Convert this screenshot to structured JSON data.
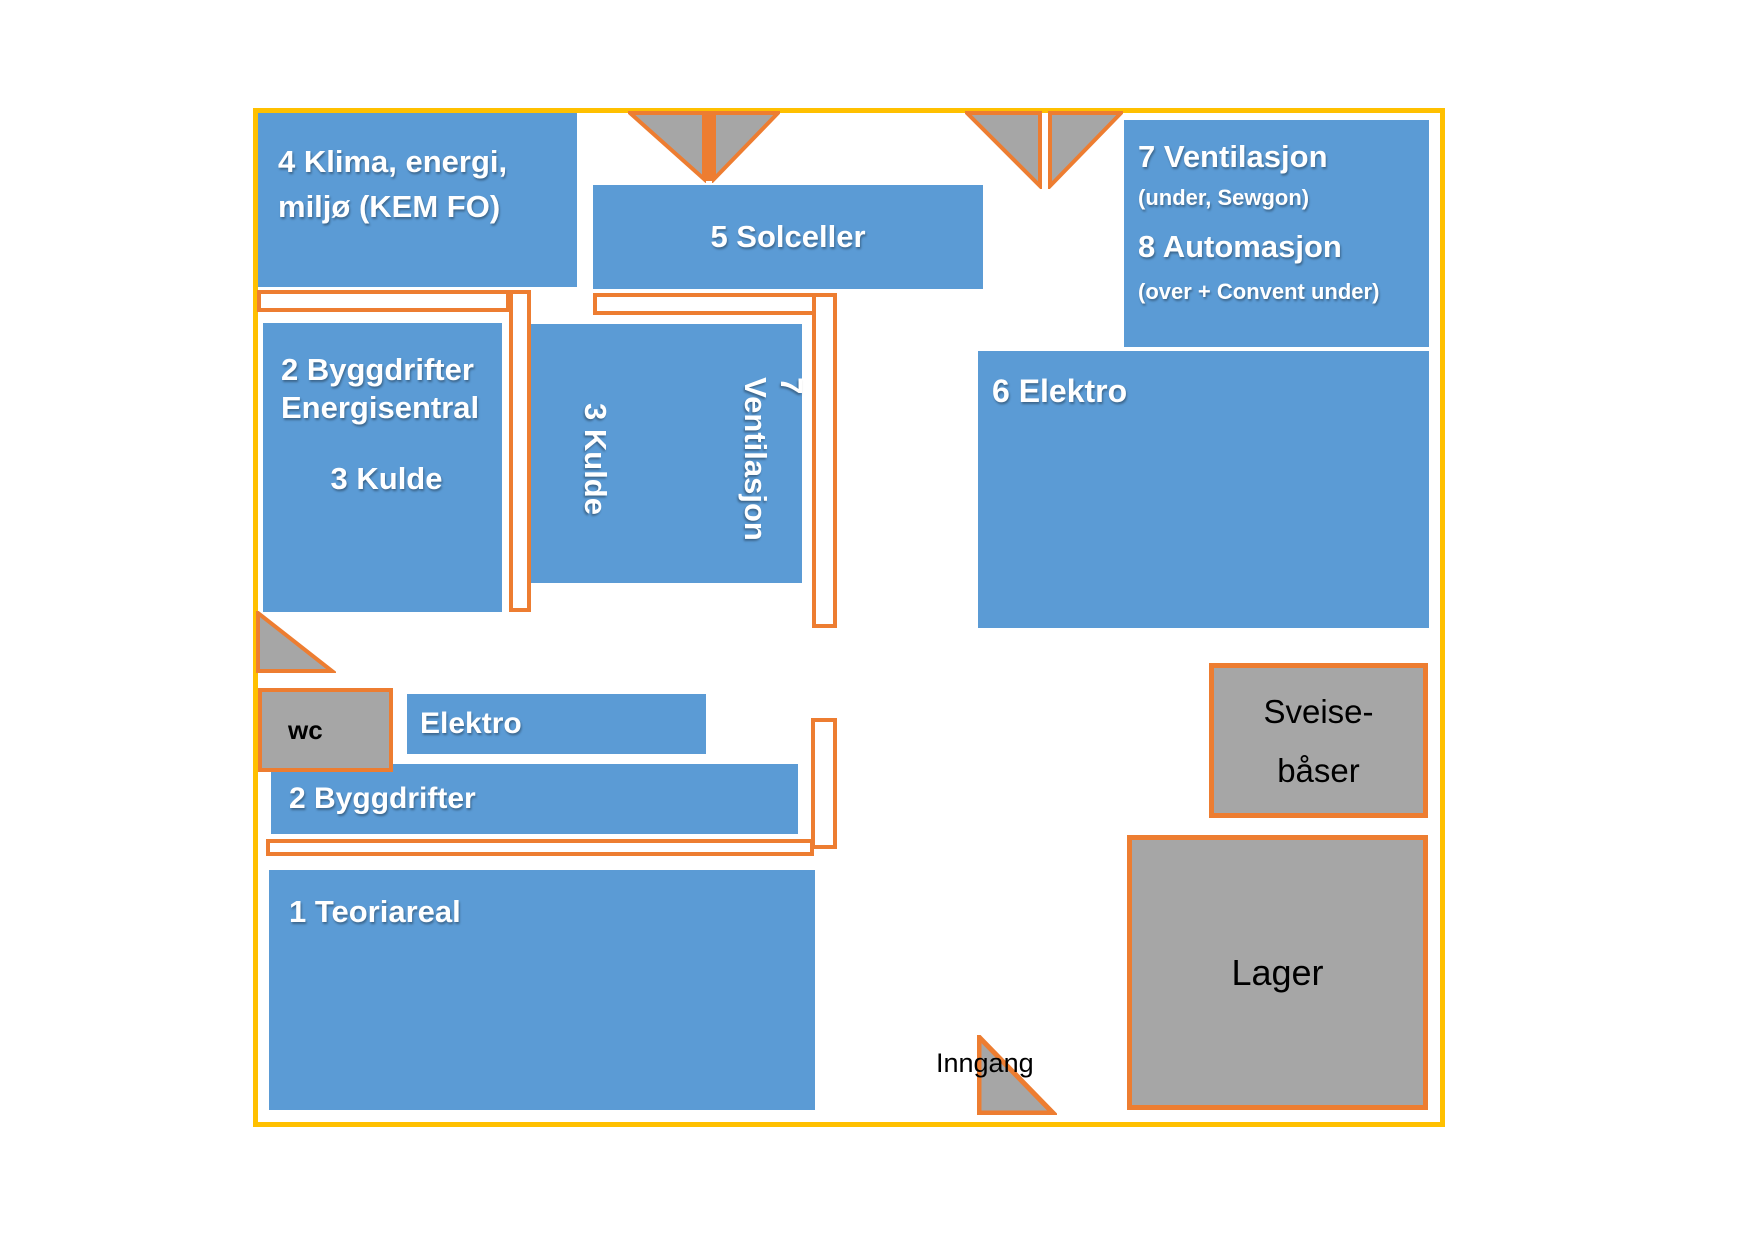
{
  "title": "Floor plan",
  "colors": {
    "blue": "#5B9BD5",
    "orange": "#ED7D31",
    "yellow": "#FFC000",
    "gray": "#A6A6A6",
    "text-on-blue": "#FFFFFF",
    "text-on-gray": "#000000"
  },
  "rooms": {
    "klima": {
      "label": "4 Klima, energi,\nmiljø (KEM FO)"
    },
    "solceller": {
      "label": "5 Solceller"
    },
    "vent_auto": {
      "line1": "7 Ventilasjon",
      "line2": "(under, Sewgon)",
      "line3": "8 Automasjon",
      "line4": "(over + Convent under)"
    },
    "bygg_energi": {
      "label": "2 Byggdrifter\nEnergisentral",
      "sublabel": "3 Kulde"
    },
    "kulde_vent": {
      "label_left": "3 Kulde",
      "label_right": "7 Ventilasjon"
    },
    "elektro6": {
      "label": "6 Elektro"
    },
    "elektro_small": {
      "label": "Elektro"
    },
    "byggdrifter2": {
      "label": "2 Byggdrifter"
    },
    "teoriareal": {
      "label": "1 Teoriareal"
    },
    "wc": {
      "label": "wc"
    },
    "sveisebaser": {
      "label": "Sveise-\nbåser"
    },
    "lager": {
      "label": "Lager"
    }
  },
  "annotations": {
    "entrance": "Inngang"
  }
}
